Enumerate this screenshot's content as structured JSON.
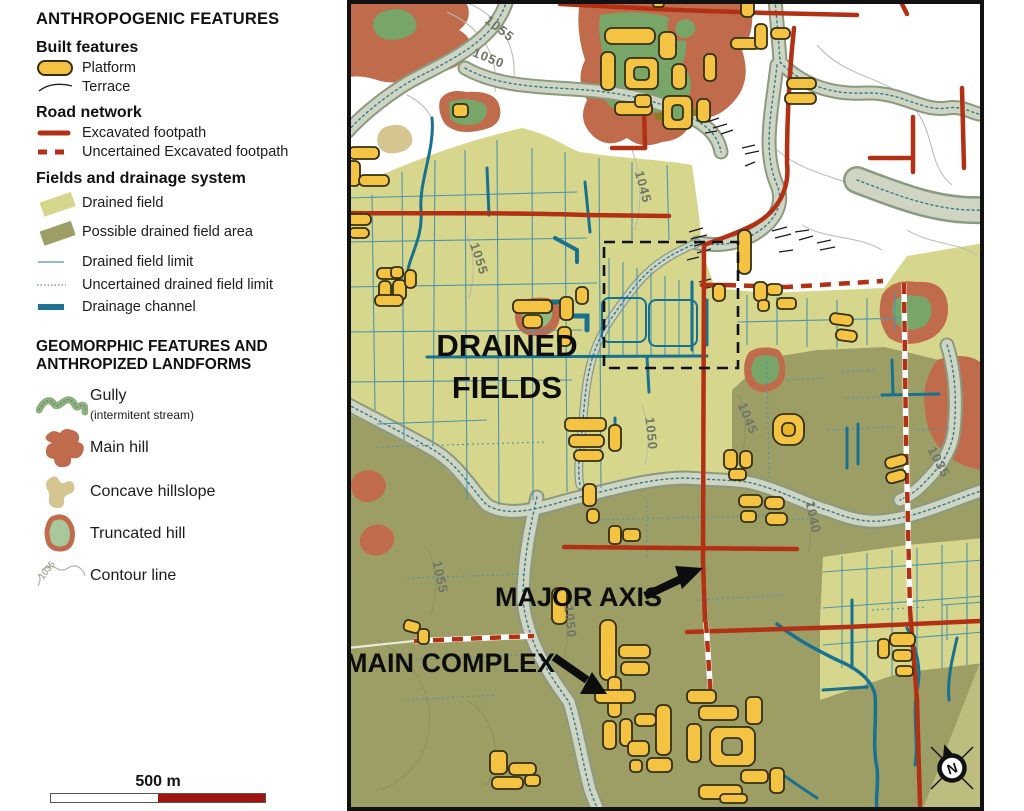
{
  "legend": {
    "title_anthropogenic": "ANTHROPOGENIC FEATURES",
    "built_features": {
      "heading": "Built features",
      "items": [
        {
          "icon": "platform-swatch",
          "label": "Platform"
        },
        {
          "icon": "terrace-line",
          "label": "Terrace"
        }
      ]
    },
    "road_network": {
      "heading": "Road network",
      "items": [
        {
          "icon": "solid-red-line",
          "label": "Excavated footpath"
        },
        {
          "icon": "dashed-red-line",
          "label": "Uncertained Excavated footpath"
        }
      ]
    },
    "fields_drainage": {
      "heading": "Fields and drainage system",
      "items": [
        {
          "icon": "drained-field-swatch",
          "label": "Drained field"
        },
        {
          "icon": "possible-drained-field-swatch",
          "label": "Possible drained field area"
        },
        {
          "icon": "thin-blue-line",
          "label": "Drained field limit"
        },
        {
          "icon": "dotted-blue-line",
          "label": "Uncertained drained field limit"
        },
        {
          "icon": "thick-teal-line",
          "label": "Drainage channel"
        }
      ]
    },
    "title_geomorphic_line1": "GEOMORPHIC FEATURES AND",
    "title_geomorphic_line2": "ANTHROPIZED LANDFORMS",
    "geomorphic_items": [
      {
        "icon": "gully-squiggle",
        "label": "Gully",
        "sublabel": "(intermitent stream)"
      },
      {
        "icon": "main-hill-blob",
        "label": "Main hill"
      },
      {
        "icon": "concave-hillslope-blob",
        "label": "Concave hillslope"
      },
      {
        "icon": "truncated-hill-blob",
        "label": "Truncated hill"
      },
      {
        "icon": "contour-line-sample",
        "label": "Contour line",
        "sample_value": "1035"
      }
    ]
  },
  "scalebar": {
    "label": "500 m"
  },
  "map": {
    "labels": {
      "drained_fields_line1": "DRAINED",
      "drained_fields_line2": "FIELDS",
      "major_axis": "MAJOR AXIS",
      "main_complex": "MAIN COMPLEX"
    },
    "compass_letter": "N",
    "contour_labels": [
      {
        "text": "1055"
      },
      {
        "text": "1050"
      },
      {
        "text": "1045"
      },
      {
        "text": "1055"
      },
      {
        "text": "1050"
      },
      {
        "text": "1045"
      },
      {
        "text": "1055"
      },
      {
        "text": "1050"
      },
      {
        "text": "1040"
      },
      {
        "text": "1035"
      }
    ]
  },
  "colors": {
    "drained_field": "#d6d78c",
    "drained_field_pale_wedge": "#bcbd7e",
    "possible_drained_field": "#9c9e66",
    "main_hill": "#c06b4c",
    "truncated_hill_green": "#77a668",
    "concave_hillslope": "#d4c591",
    "gully_fill": "#cfd5c2",
    "road_red": "#b23114",
    "drainage_teal": "#18718f",
    "field_limit_blue": "#4f93ab",
    "platform_yellow": "#f5c344",
    "scalebar_red": "#9e1410"
  }
}
